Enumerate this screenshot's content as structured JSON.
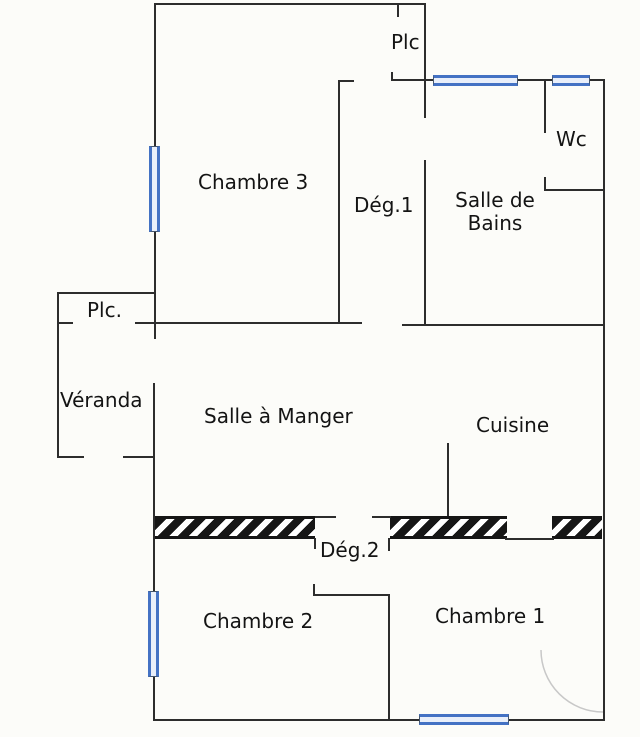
{
  "plan": {
    "type": "apartment-floor-plan",
    "rooms": {
      "plc_top": "Plc",
      "chambre3": "Chambre 3",
      "deg1": "Dég.1",
      "salle_de_bains": "Salle de Bains",
      "wc": "Wc",
      "plc_left": "Plc.",
      "veranda": "Véranda",
      "salle_a_manger": "Salle à Manger",
      "cuisine": "Cuisine",
      "deg2": "Dég.2",
      "chambre2": "Chambre 2",
      "chambre1": "Chambre 1"
    },
    "colors": {
      "wall": "#2d2d2d",
      "window_frame": "#4472c4",
      "window_fill": "#e9effa",
      "hatch": "#161616",
      "background": "#fcfcf9",
      "label": "#141414"
    }
  }
}
